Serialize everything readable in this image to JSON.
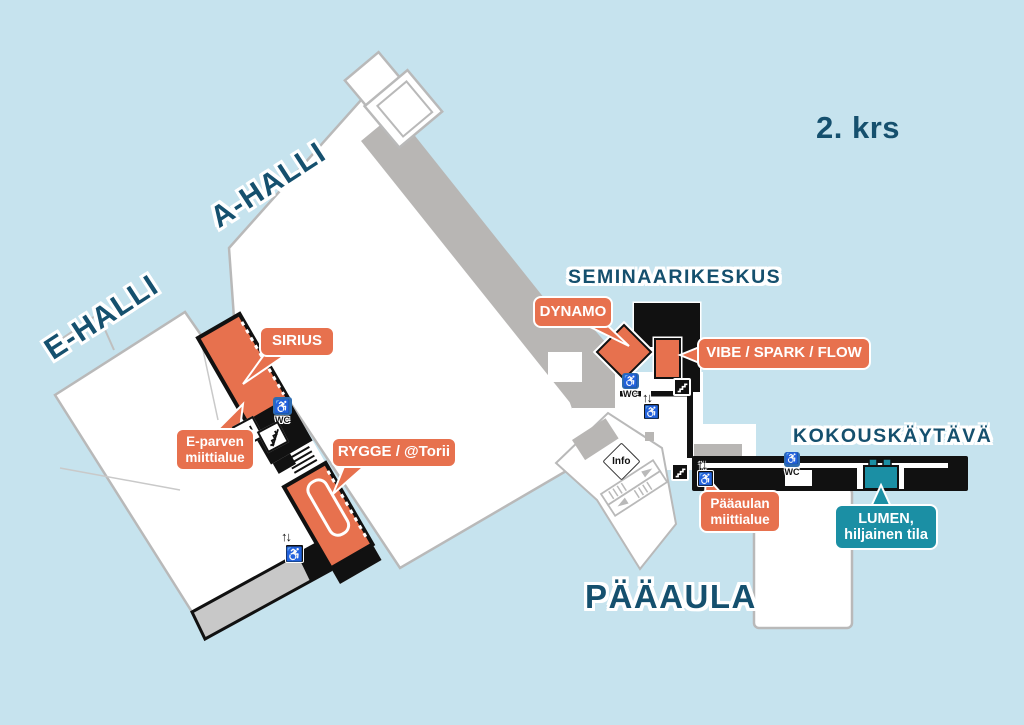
{
  "floor_label": "2. krs",
  "area_labels": {
    "a_halli": "A-HALLI",
    "e_halli": "E-HALLI",
    "seminaarikeskus": "SEMINAARIKESKUS",
    "kokouskaytava": "KOKOUSKÄYTÄVÄ",
    "paaaula": "PÄÄAULA"
  },
  "callouts": {
    "sirius": {
      "label": "SIRIUS"
    },
    "e_parvi": {
      "lines": [
        "E-parven",
        "miittialue"
      ]
    },
    "rygge": {
      "label": "RYGGE / @Torii"
    },
    "dynamo": {
      "label": "DYNAMO"
    },
    "vibe": {
      "label": "VIBE / SPARK / FLOW"
    },
    "paaaula_miitti": {
      "lines": [
        "Pääaulan",
        "miittialue"
      ]
    },
    "lumen": {
      "lines": [
        "LUMEN,",
        "hiljainen tila"
      ]
    }
  },
  "icons": {
    "wc": "WC",
    "info": "Info",
    "elevator": "↑↓",
    "wheelchair": "♿"
  },
  "colors": {
    "background": "#C6E3EE",
    "room_orange": "#E7714E",
    "quiet_room_teal": "#1B8FA4",
    "label_blue": "#15506E",
    "building_white": "#FFFFFF",
    "outline_gray": "#B9B9B9",
    "wall_black": "#111111",
    "wc_blue": "#2E6CB0"
  }
}
